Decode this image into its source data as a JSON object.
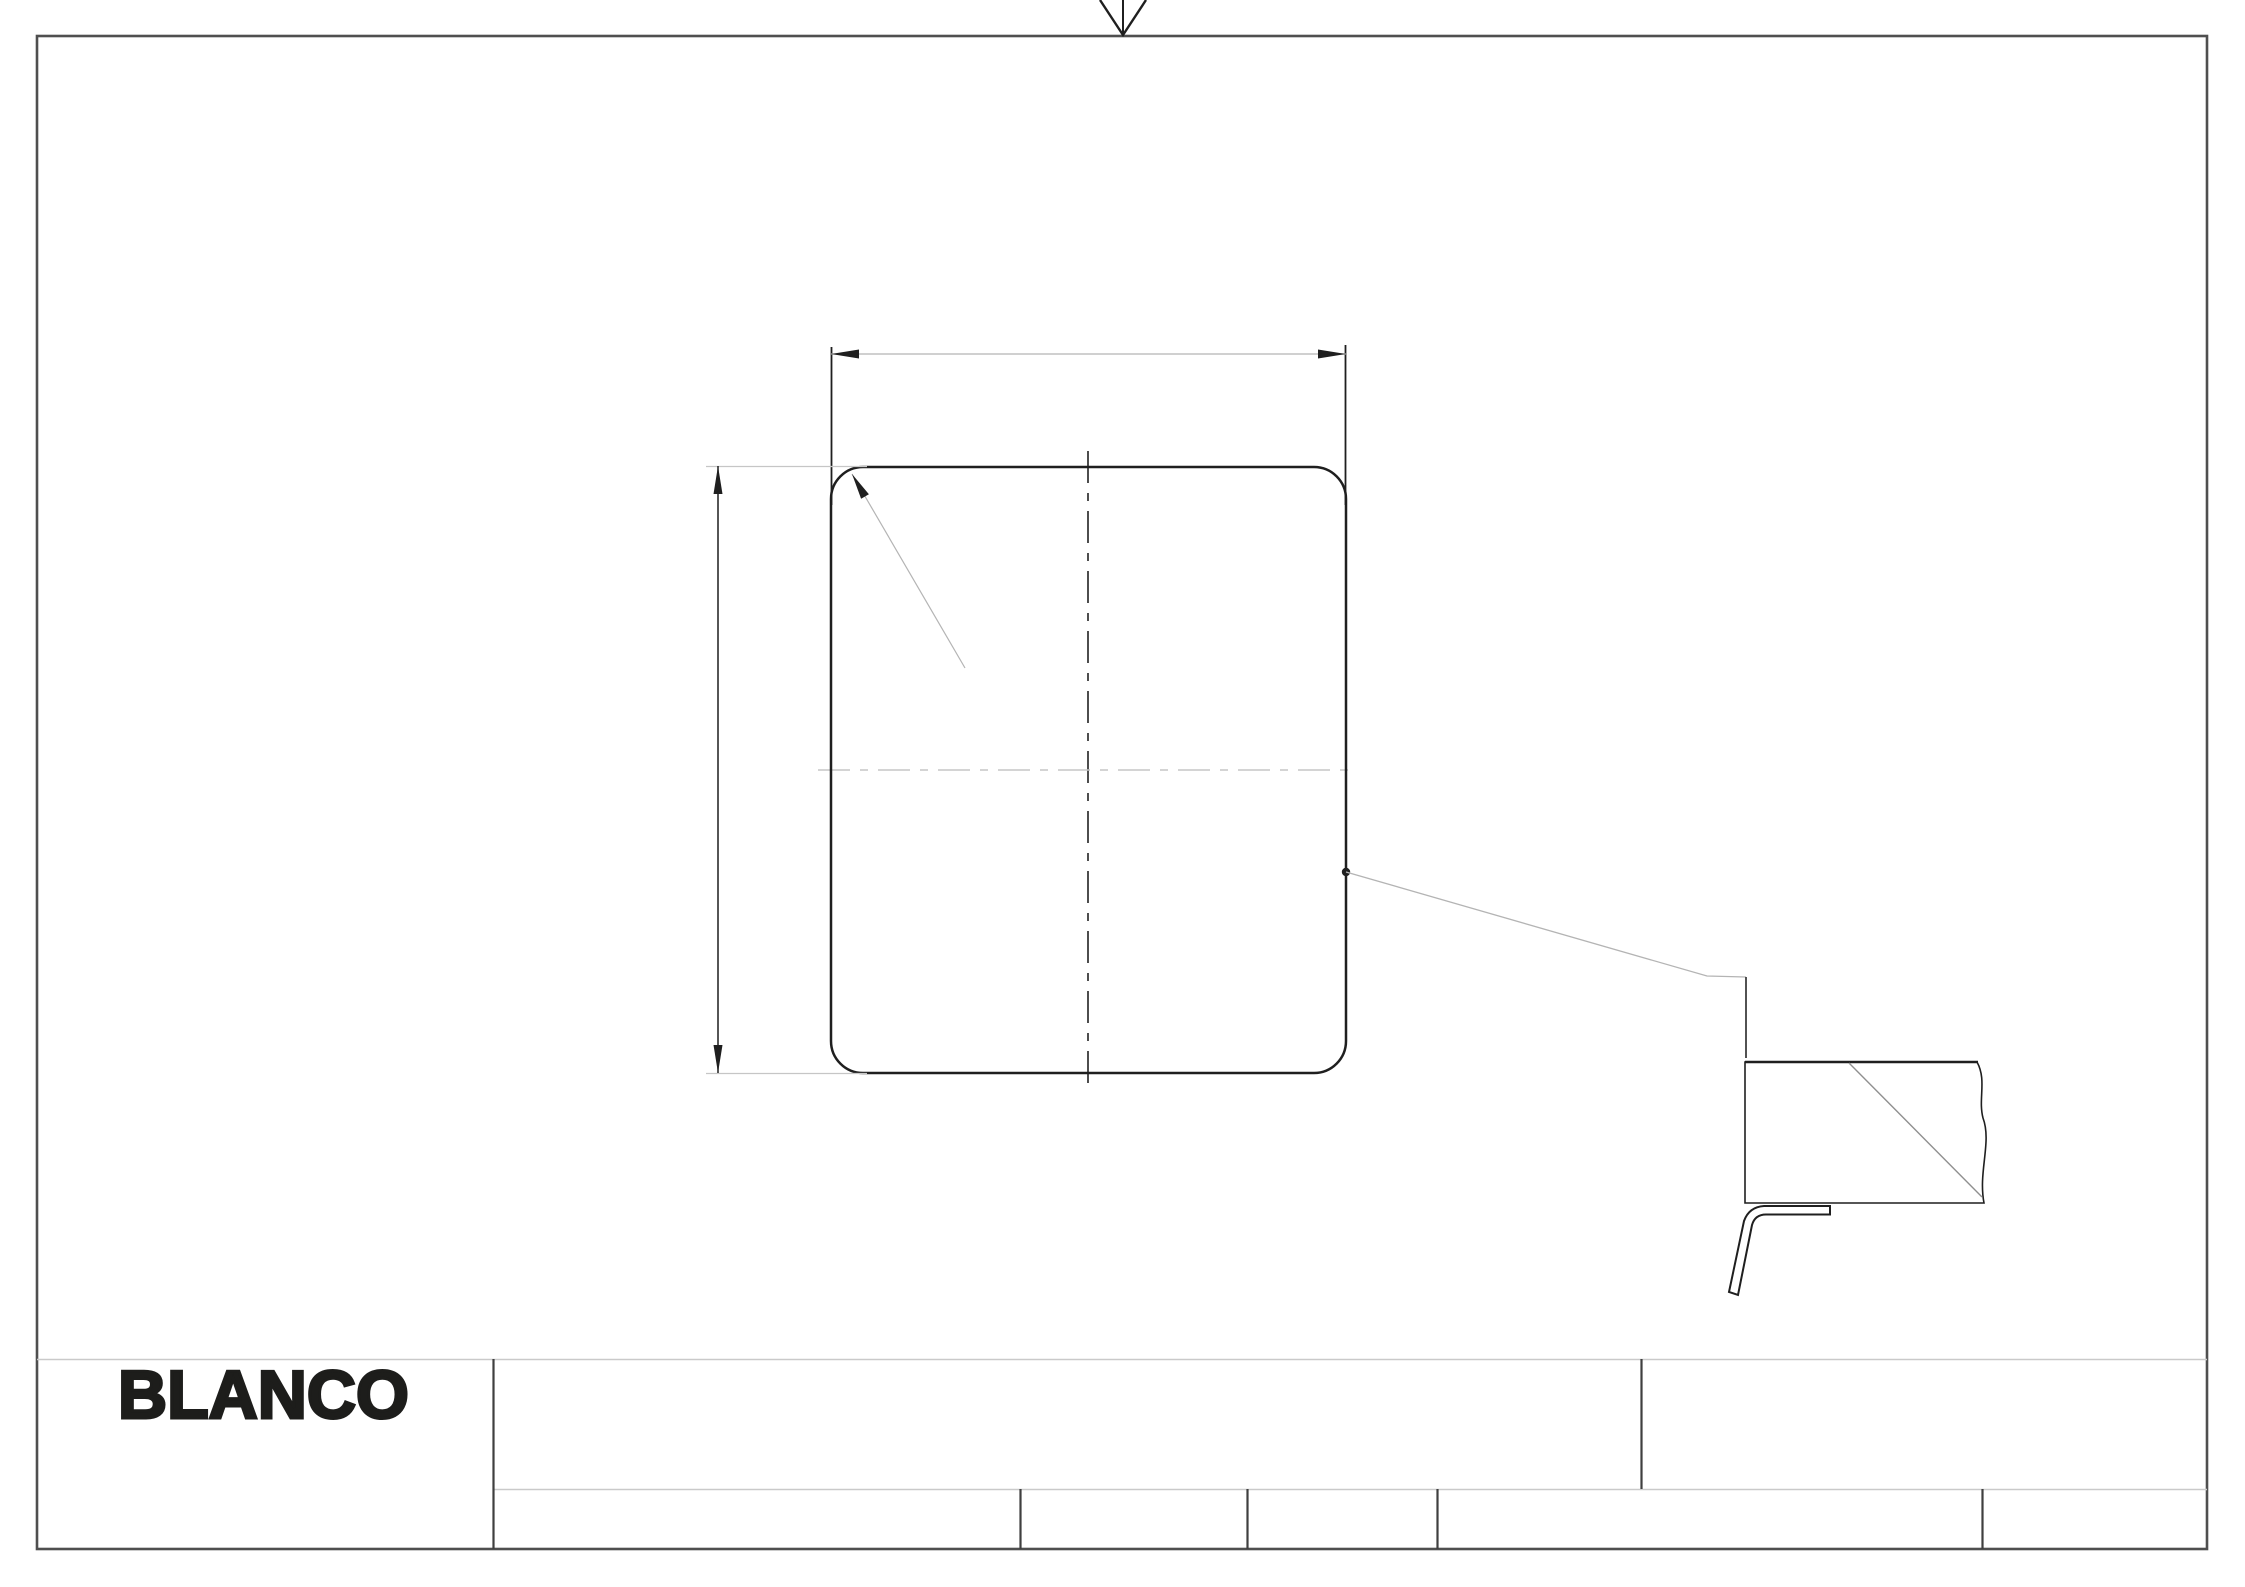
{
  "title_block": {
    "brand": "BLANCO",
    "cells": {
      "logo_cell": "BLANCO",
      "description_cell": "",
      "right_info_cell": "",
      "bottom_row_cells": [
        "",
        "",
        "",
        "",
        ""
      ]
    }
  },
  "drawing": {
    "type": "technical-cutout-drawing",
    "sheet_marks": [
      "top-center-fold-mark"
    ],
    "views": [
      {
        "name": "sink-cutout-plan-view",
        "shape": "rounded-rectangle",
        "annotations": [
          "horizontal-width-dimension",
          "vertical-height-dimension",
          "corner-radius-leader",
          "edge-detail-leader-dot",
          "vertical-centerline",
          "horizontal-centerline"
        ],
        "dimension_text_visible": false
      },
      {
        "name": "counter-edge-cross-section",
        "parts": [
          "countertop-crosshatched-section",
          "sink-rim-flange-profile",
          "break-line-right-edge"
        ]
      }
    ]
  },
  "colors": {
    "background": "#ffffff",
    "ink": "#1f1f1f",
    "frame": "#4f4f4f",
    "dim_line": "#b4b4b4",
    "centerline_dark": "#3a3a3a",
    "centerline_light": "#c6c6c6",
    "hatch": "#bcbcbc",
    "hatch_accent": "#8f8f8f",
    "titleblock_rule_light": "#cacaca",
    "titleblock_rule_dark": "#3f3f3f",
    "logo": "#1d1d1b"
  }
}
